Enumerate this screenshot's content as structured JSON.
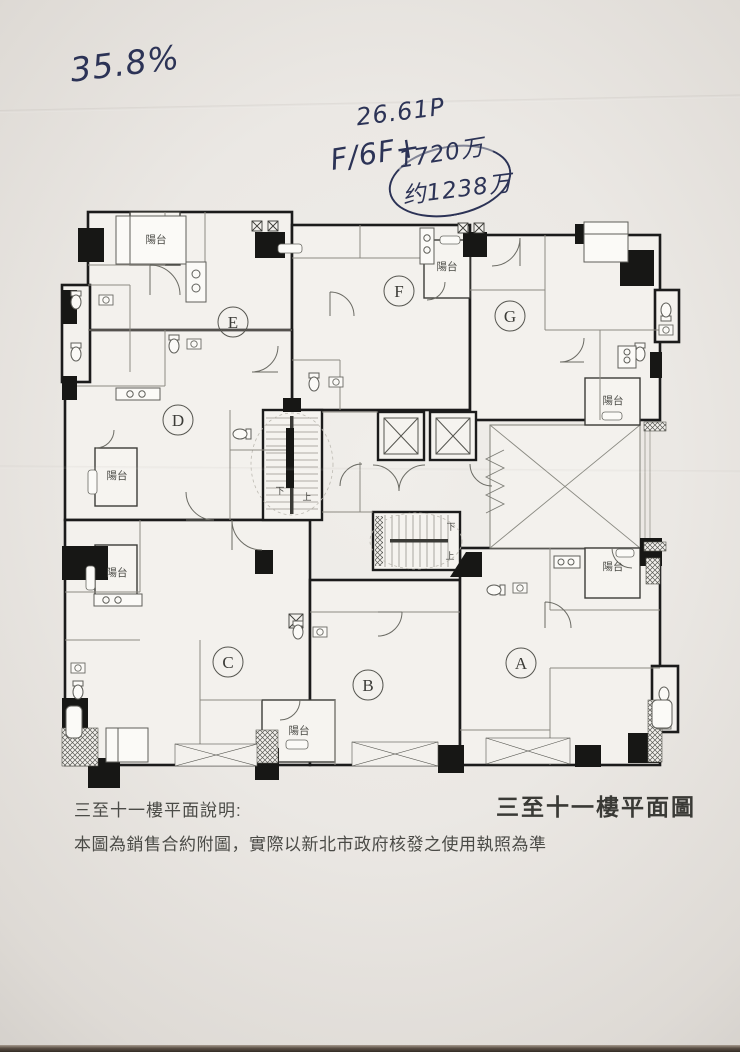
{
  "handwriting": {
    "percentage": "35.8%",
    "area": "26.61P",
    "unit_floor": "F/6F+",
    "price_top": "1720万",
    "price_circled": "约1238万"
  },
  "plan": {
    "units": [
      "A",
      "B",
      "C",
      "D",
      "E",
      "F",
      "G"
    ],
    "balcony_label": "陽台",
    "stair_up_label": "上",
    "stair_down_label": "下"
  },
  "captions": {
    "note_title": "三至十一樓平面說明:",
    "note_body": "本圖為銷售合約附圖，實際以新北市政府核發之使用執照為準",
    "plan_title": "三至十一樓平面圖"
  },
  "colors": {
    "ink": "#2c3356",
    "wall": "#1b1b1b",
    "paper": "#ece9e5"
  }
}
